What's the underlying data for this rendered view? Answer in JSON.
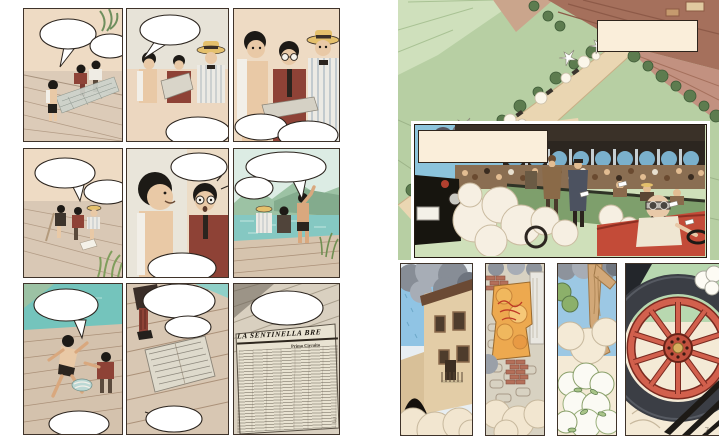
{
  "spread": {
    "type": "comic-book-two-page-spread",
    "left_page": {
      "page_mark": "3",
      "newspaper": {
        "headline": "LA SENTINELLA BRE",
        "subhead": "Primo Circuito"
      },
      "panels": [
        {
          "name": "boys-hauling-net-on-pier",
          "speech_bubbles": [
            "",
            ""
          ]
        },
        {
          "name": "trio-talking-one-reads-paper",
          "speech_bubbles": [
            "",
            ""
          ]
        },
        {
          "name": "trio-closeup-over-newspaper",
          "speech_bubbles": [
            "",
            ""
          ]
        },
        {
          "name": "boys-seated-on-pier",
          "speech_bubbles": [
            "",
            ""
          ]
        },
        {
          "name": "smiling-boy-shocked-friend-closeup",
          "speech_bubbles": [
            "",
            ""
          ]
        },
        {
          "name": "boy-pointing-across-lake",
          "speech_bubbles": [
            "",
            ""
          ]
        },
        {
          "name": "boy-dashing-off-pier",
          "speech_bubbles": [
            "",
            ""
          ]
        },
        {
          "name": "newspaper-left-on-planks",
          "speech_bubbles": [
            "",
            "",
            ""
          ]
        },
        {
          "name": "newspaper-front-page-closeup",
          "speech_bubbles": [
            ""
          ]
        }
      ]
    },
    "right_page": {
      "page_mark": "7",
      "caption_top": "",
      "caption_middle": "",
      "panels": [
        {
          "name": "aerial-country-roads-race-convoy"
        },
        {
          "name": "grandstand-crowd-race-cars-driver"
        },
        {
          "name": "village-building-dust"
        },
        {
          "name": "stone-wall-torn-poster"
        },
        {
          "name": "tree-and-flowering-bush-dust"
        },
        {
          "name": "red-spoked-wheel-closeup"
        }
      ]
    }
  },
  "palette": {
    "paper_white": "#ffffff",
    "caption_cream": "#faeeda",
    "ink": "#2b241e",
    "skin": "#e9c9a6",
    "maroon_jacket": "#8e4236",
    "straw_hat": "#e4c06c",
    "dock_wood": "#d9c8b5",
    "water_teal": "#7fc6c0",
    "mountain_green": "#9cc2a4",
    "aerial_green": "#b7cfa3",
    "road_tan": "#ead6b2",
    "field_brown": "#a5705c",
    "sky_blue": "#8cc4dc",
    "stand_green_wall": "#7e9f6c",
    "race_car_red": "#c34b38",
    "dust_cream": "#f4ead6",
    "smoke_gray": "#8d939c",
    "poster_orange": "#eda94f",
    "poster_red": "#bf3a26",
    "wheel_red": "#d2604d",
    "tire_dark": "#3b3e45"
  }
}
